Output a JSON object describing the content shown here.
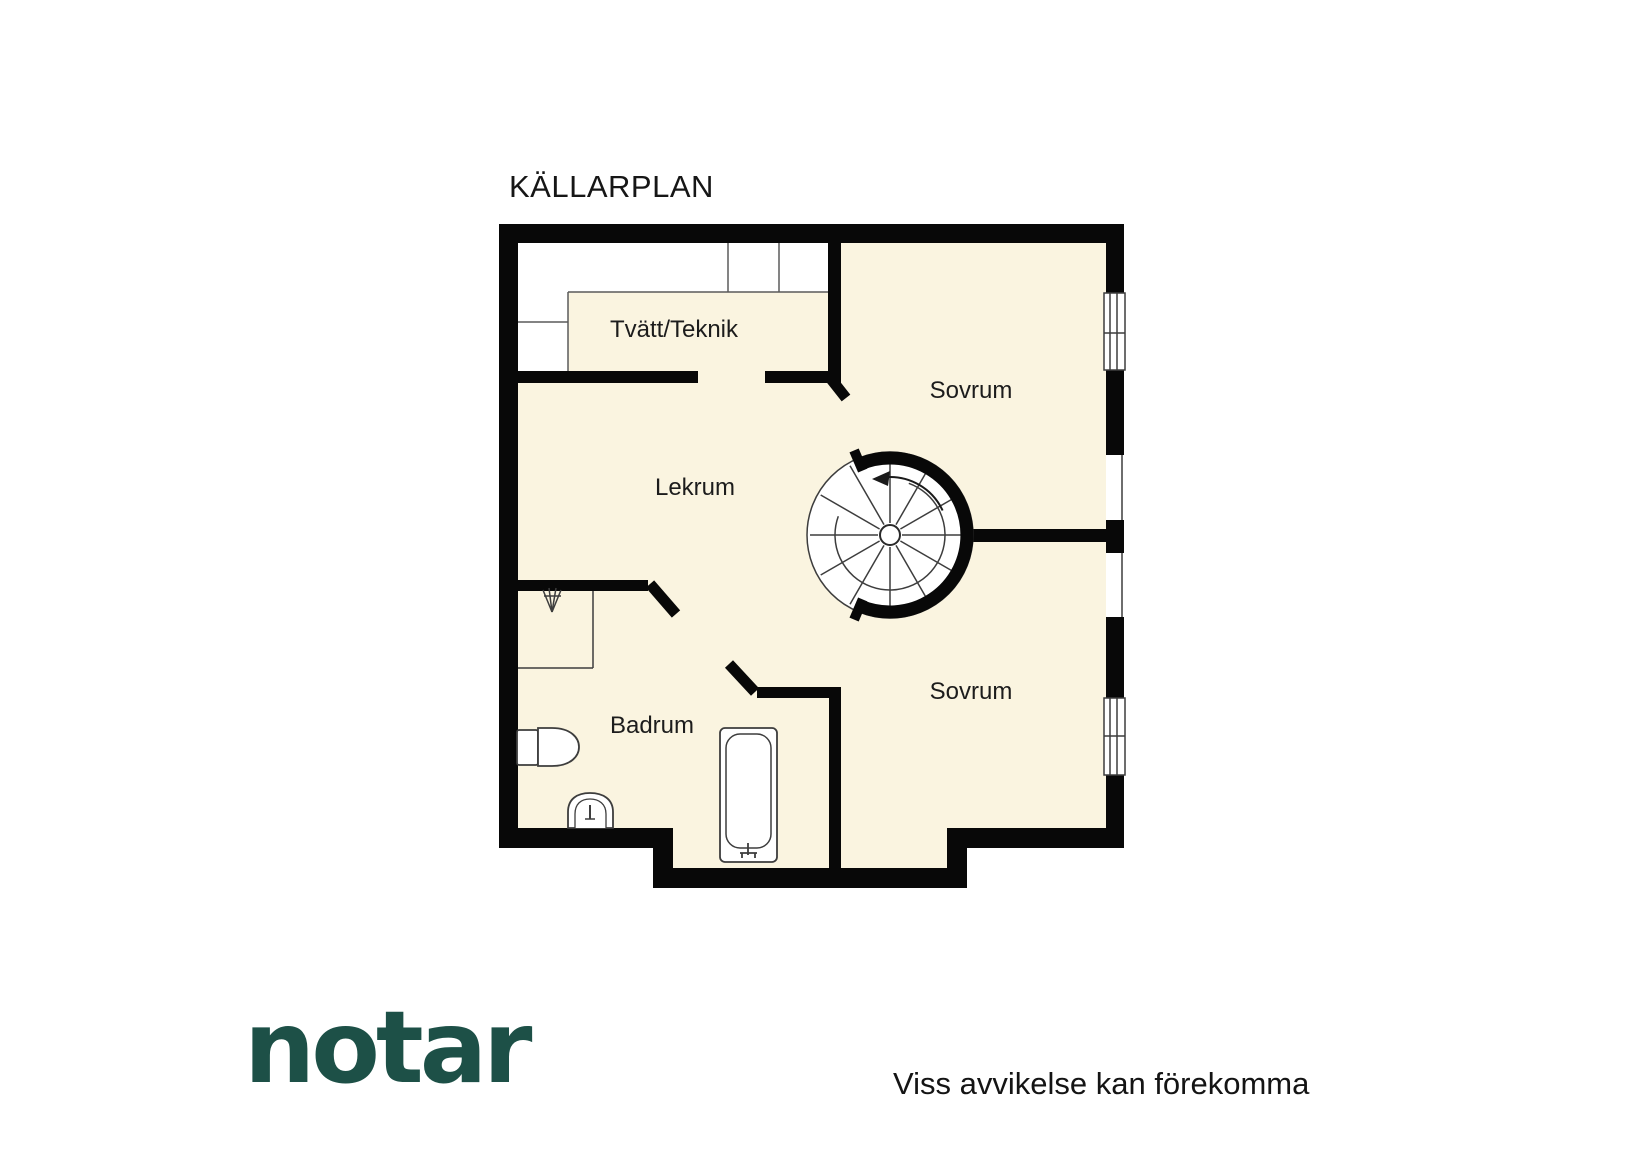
{
  "floorplan": {
    "title": "KÄLLARPLAN",
    "rooms": [
      {
        "id": "tvatt-teknik",
        "label": "Tvätt/Teknik"
      },
      {
        "id": "sovrum-top",
        "label": "Sovrum"
      },
      {
        "id": "lekrum",
        "label": "Lekrum"
      },
      {
        "id": "badrum",
        "label": "Badrum"
      },
      {
        "id": "sovrum-bottom",
        "label": "Sovrum"
      }
    ],
    "fixtures": [
      "spiral-staircase",
      "shower",
      "toilet",
      "sink",
      "bathtub",
      "counter-cabinets",
      "window",
      "window"
    ],
    "colors": {
      "floor": "#faf4e0",
      "wall": "#080808",
      "fixture-line": "#3d3d3d",
      "background": "#ffffff"
    }
  },
  "footer": {
    "logo_text": "notar",
    "logo_color": "#1d5047",
    "disclaimer": "Viss avvikelse kan förekomma"
  }
}
